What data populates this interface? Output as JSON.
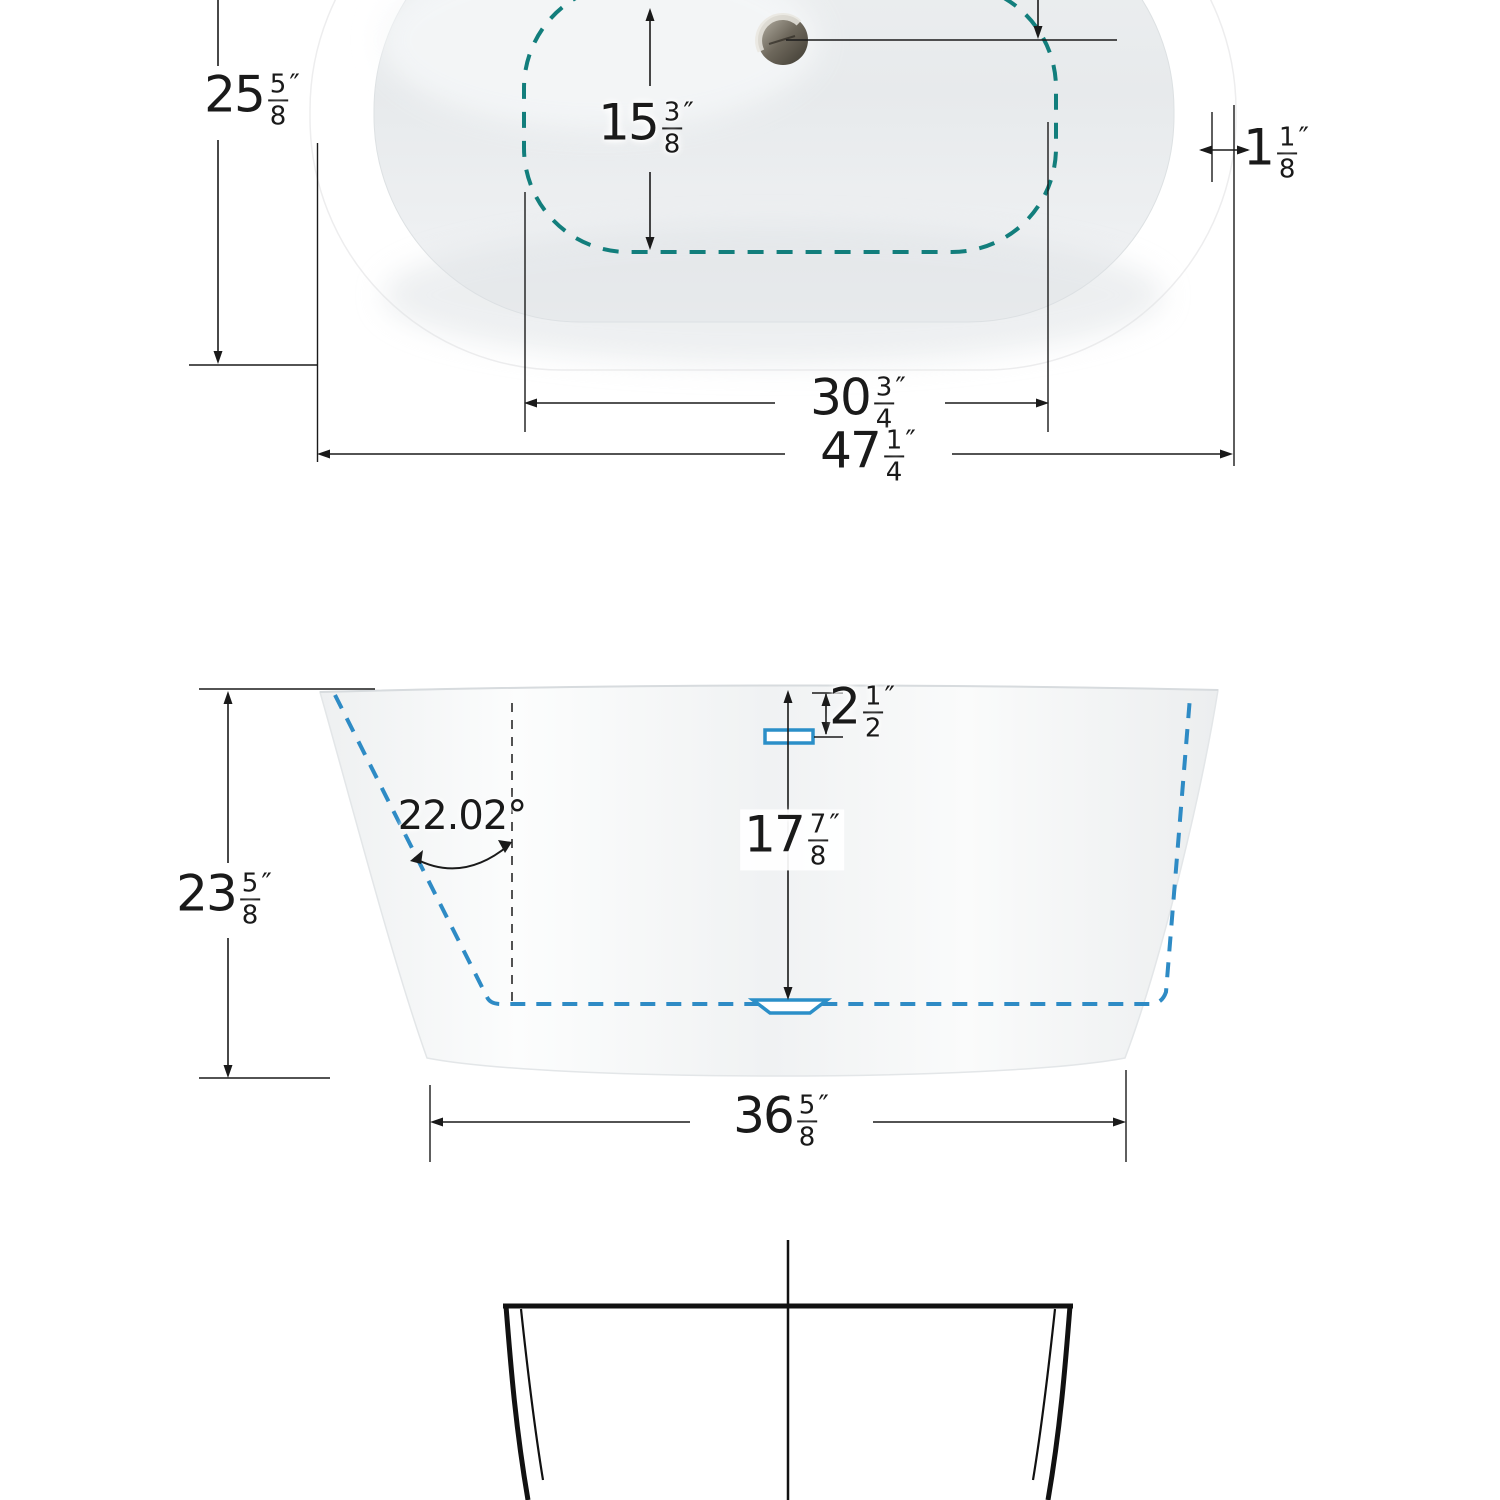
{
  "title": "Freestanding bathtub dimension drawing",
  "colors": {
    "teal_dash": "#127E7C",
    "blue_dash": "#2E8BC5",
    "line": "#1A1A1A",
    "tub": "#FFFFFF"
  },
  "top_view": {
    "overall_length": {
      "whole": "47",
      "num": "1",
      "den": "4",
      "unit": "″"
    },
    "basin_length": {
      "whole": "30",
      "num": "3",
      "den": "4",
      "unit": "″"
    },
    "overall_width": {
      "whole": "25",
      "num": "5",
      "den": "8",
      "unit": "″"
    },
    "basin_width": {
      "whole": "15",
      "num": "3",
      "den": "8",
      "unit": "″"
    },
    "rim_thickness": {
      "whole": "1",
      "num": "1",
      "den": "8",
      "unit": "″"
    }
  },
  "front_view": {
    "overall_height": {
      "whole": "23",
      "num": "5",
      "den": "8",
      "unit": "″"
    },
    "interior_depth": {
      "whole": "17",
      "num": "7",
      "den": "8",
      "unit": "″"
    },
    "overflow_drop": {
      "whole": "2",
      "num": "1",
      "den": "2",
      "unit": "″"
    },
    "base_length": {
      "whole": "36",
      "num": "5",
      "den": "8",
      "unit": "″"
    },
    "wall_angle": "22.02°"
  }
}
